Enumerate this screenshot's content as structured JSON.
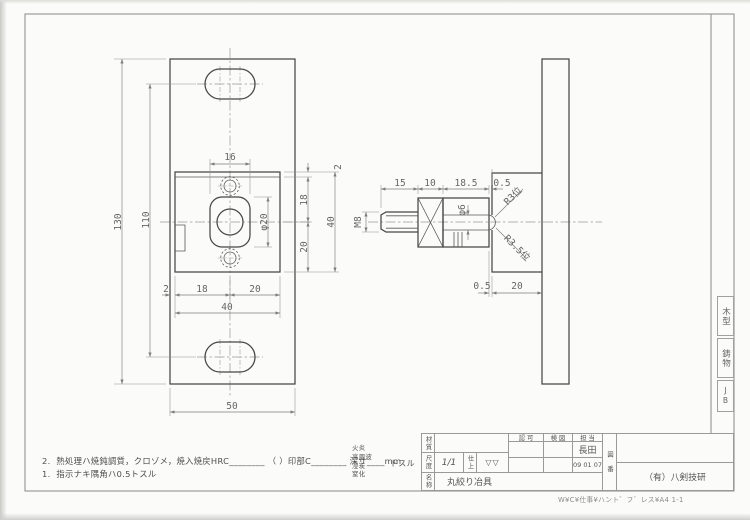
{
  "sheet": {
    "edge_column": {
      "boxes": [
        "木型",
        "鋳物",
        "JB"
      ]
    },
    "path_note": "W¥C¥仕事¥ハント゛フ゛レス¥A4 1-1"
  },
  "notes": {
    "note2_no": "2.",
    "note2": "熱処理ハ焼鈍調質，クロゾメ，焼入焼戻HRC________ （ ）印部C________ 深サ____mm",
    "options": [
      "火炎",
      "高周波",
      "浸炭",
      "窒化"
    ],
    "options_suffix": "トスル",
    "note1_no": "1.",
    "note1": "指示ナキ隅角ハ0.5トスル"
  },
  "title_block": {
    "material_label": "材質",
    "material_value": "",
    "approval_label": "認 可",
    "check_label": "検 図",
    "charge_label": "担 当",
    "charge_name": "長田",
    "date": "09 01 07",
    "scale_label": "尺度",
    "scale_value": "1/1",
    "finish_label": "仕上",
    "finish_value": "▽▽",
    "name_label": "名称",
    "name_value": "丸絞り冶具",
    "drawing_no_label": "図番",
    "company": "（有）八剣技研"
  },
  "front_view": {
    "dims": {
      "overall_height": "130",
      "slot_span": "110",
      "overall_width": "50",
      "block_width": "40",
      "left_offset": "2",
      "left_to_center": "18",
      "center_to_right": "20",
      "block_height": "40",
      "top_offset": "2",
      "top_to_center": "18",
      "center_to_bottom": "20",
      "boss_width": "16",
      "boss_dia": "φ20"
    }
  },
  "side_view": {
    "dims": {
      "stud_len": "15",
      "flange_thk": "10",
      "body_len": "18.5",
      "gap_top": "0.5",
      "thread": "M8",
      "pin_dia": "φ6",
      "tip_r1": "R3位",
      "tip_r2": "R3.5位",
      "gap_bottom": "0.5",
      "bracket_thk": "20"
    }
  },
  "colors": {
    "line": "#474747",
    "dim": "#7d7d7d",
    "paper": "#fbfbf9"
  }
}
